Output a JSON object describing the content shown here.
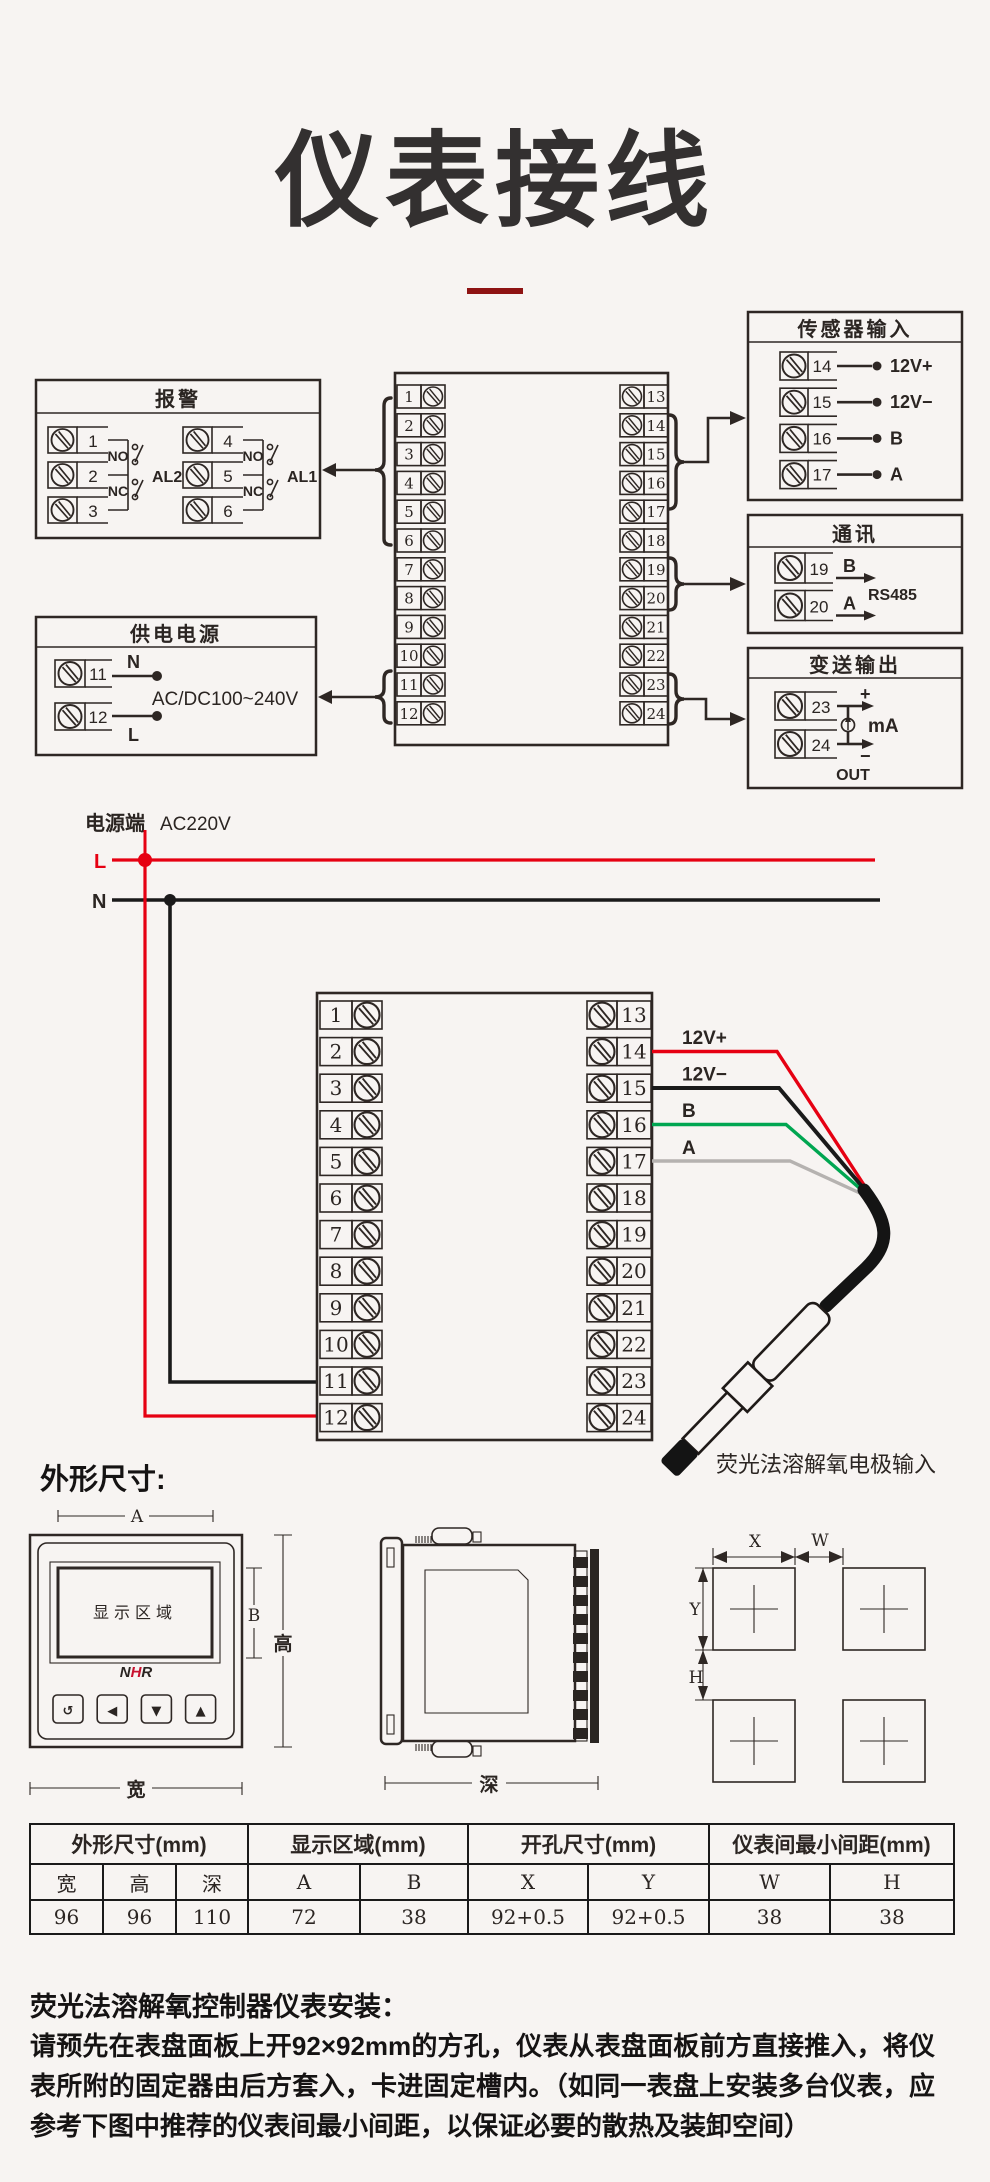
{
  "page": {
    "title": "仪表接线",
    "accent": "#8e1313"
  },
  "d1": {
    "alarm": {
      "title": "报警",
      "g1": {
        "terminals": [
          "1",
          "2",
          "3"
        ],
        "no": "NO",
        "nc": "NC",
        "name": "AL2"
      },
      "g2": {
        "terminals": [
          "4",
          "5",
          "6"
        ],
        "no": "NO",
        "nc": "NC",
        "name": "AL1"
      }
    },
    "power": {
      "title": "供电电源",
      "terminals": [
        "11",
        "12"
      ],
      "n": "N",
      "l": "L",
      "range": "AC/DC100~240V"
    },
    "block": {
      "left": [
        "1",
        "2",
        "3",
        "4",
        "5",
        "6",
        "7",
        "8",
        "9",
        "10",
        "11",
        "12"
      ],
      "right": [
        "13",
        "14",
        "15",
        "16",
        "17",
        "18",
        "19",
        "20",
        "21",
        "22",
        "23",
        "24"
      ]
    },
    "sensor": {
      "title": "传感器输入",
      "rows": [
        {
          "t": "14",
          "label": "12V+"
        },
        {
          "t": "15",
          "label": "12V−"
        },
        {
          "t": "16",
          "label": "B"
        },
        {
          "t": "17",
          "label": "A"
        }
      ]
    },
    "comm": {
      "title": "通讯",
      "rows": [
        {
          "t": "19",
          "label": "B"
        },
        {
          "t": "20",
          "label": "A"
        }
      ],
      "bus": "RS485"
    },
    "out": {
      "title": "变送输出",
      "terminals": [
        "23",
        "24"
      ],
      "plus": "+",
      "minus": "−",
      "unit": "mA",
      "out": "OUT"
    }
  },
  "d2": {
    "source": "电源端",
    "voltage": "AC220V",
    "l": "L",
    "n": "N",
    "block": {
      "left": [
        "1",
        "2",
        "3",
        "4",
        "5",
        "6",
        "7",
        "8",
        "9",
        "10",
        "11",
        "12"
      ],
      "right": [
        "13",
        "14",
        "15",
        "16",
        "17",
        "18",
        "19",
        "20",
        "21",
        "22",
        "23",
        "24"
      ]
    },
    "wires": [
      "12V+",
      "12V−",
      "B",
      "A"
    ],
    "wire_colors": [
      "#e60012",
      "#1a1a1a",
      "#00a651",
      "#b5b2b0"
    ],
    "probe_label": "荧光法溶解氧电极输入"
  },
  "dims": {
    "heading": "外形尺寸:",
    "front": {
      "a": "A",
      "b": "B",
      "h": "高",
      "w": "宽",
      "display": "显示区域",
      "logo": {
        "n": "N",
        "h": "H",
        "r": "R"
      },
      "buttons": [
        "↺",
        "◀",
        "▼",
        "▲"
      ]
    },
    "side": {
      "depth": "深"
    },
    "cut": {
      "x": "X",
      "w": "W",
      "y": "Y",
      "h": "H"
    }
  },
  "table": {
    "groups": [
      "外形尺寸(mm)",
      "显示区域(mm)",
      "开孔尺寸(mm)",
      "仪表间最小间距(mm)"
    ],
    "headers": [
      "宽",
      "高",
      "深",
      "A",
      "B",
      "X",
      "Y",
      "W",
      "H"
    ],
    "values": [
      "96",
      "96",
      "110",
      "72",
      "38",
      "92+0.5",
      "92+0.5",
      "38",
      "38"
    ]
  },
  "install": {
    "heading": "荧光法溶解氧控制器仪表安装：",
    "body": "请预先在表盘面板上开92×92mm的方孔，仪表从表盘面板前方直接推入，将仪表所附的固定器由后方套入，卡进固定槽内。（如同一表盘上安装多台仪表，应参考下图中推荐的仪表间最小间距，以保证必要的散热及装卸空间）"
  }
}
